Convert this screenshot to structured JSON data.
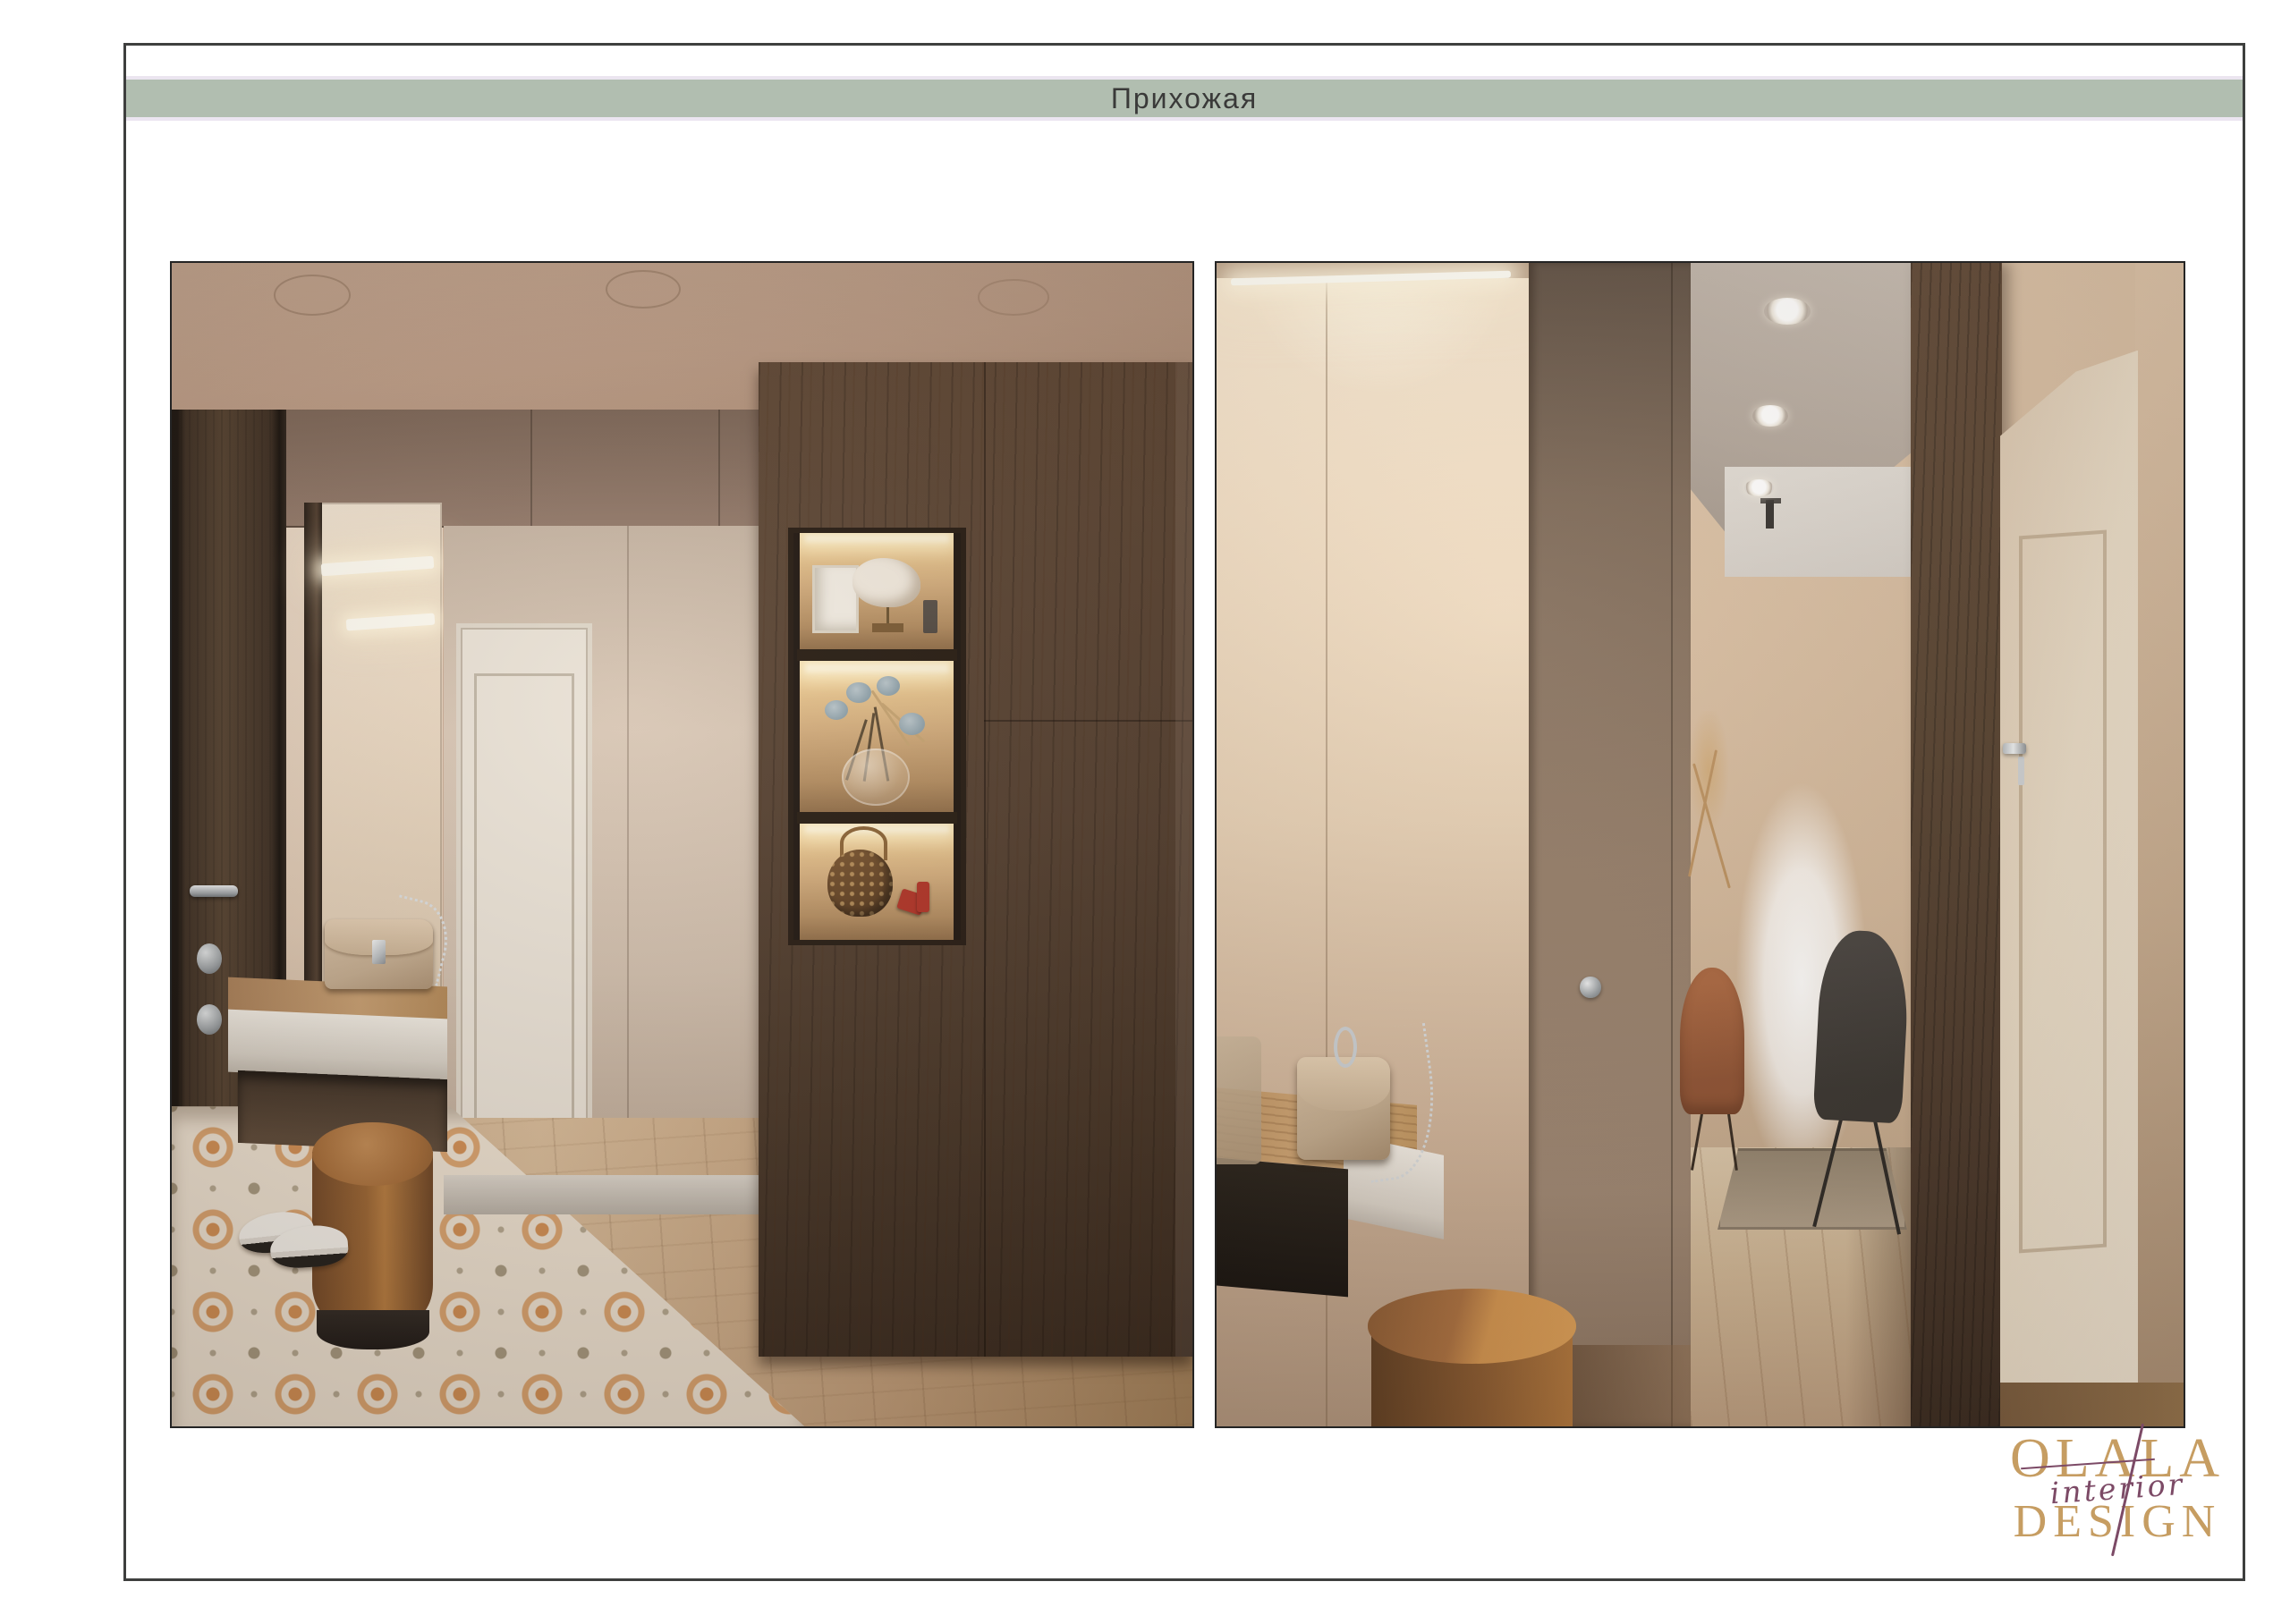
{
  "page": {
    "title": "Прихожая"
  },
  "logo": {
    "line1": "OLALA",
    "line2": "interior",
    "line3": "DESIGN"
  },
  "colors": {
    "header_bar": "#b1beb0",
    "header_text": "#3a3a39",
    "frame_border": "#3e3f3e",
    "logo_gold": "#c69d62",
    "logo_plum": "#7c4a66"
  }
}
